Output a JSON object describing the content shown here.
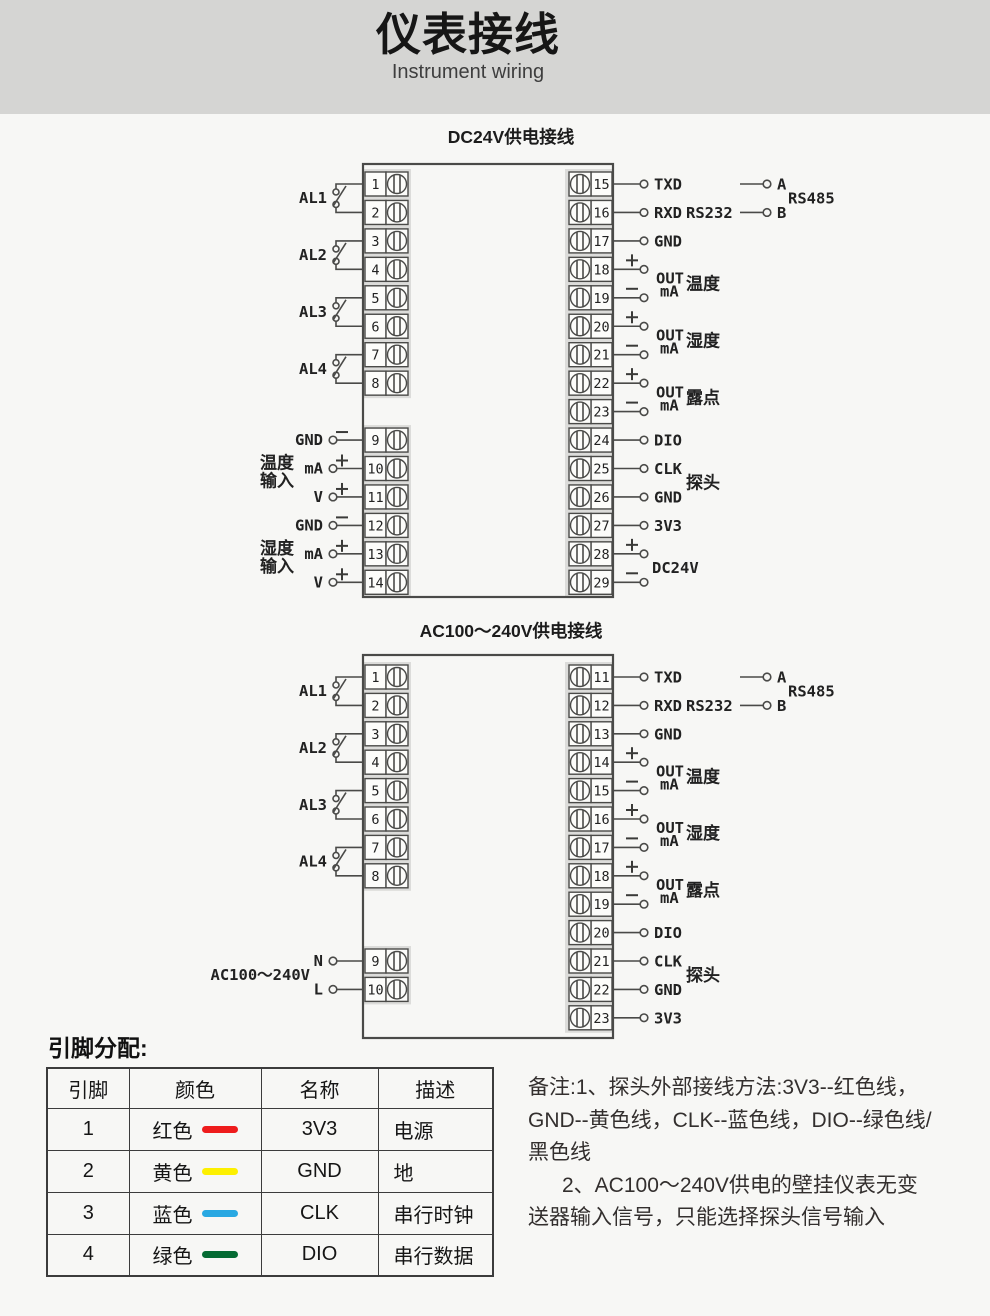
{
  "header": {
    "title": "仪表接线",
    "subtitle": "Instrument wiring"
  },
  "colors": {
    "header_bg": "#d5d5d3",
    "page_bg": "#f7f7f5",
    "line": "#4a4a48"
  },
  "diagrams": [
    {
      "name": "dc24v-wiring-diagram",
      "title": "DC24V供电接线",
      "layout": {
        "rect": {
          "x": 363,
          "y": 164,
          "w": 250,
          "h": 433
        },
        "row_start": 172,
        "row_pitch": 28.45,
        "cell_h": 24,
        "title_y": 143
      },
      "left_terminals": [
        {
          "n": "1",
          "row": 0
        },
        {
          "n": "2",
          "row": 1
        },
        {
          "n": "3",
          "row": 2
        },
        {
          "n": "4",
          "row": 3
        },
        {
          "n": "5",
          "row": 4
        },
        {
          "n": "6",
          "row": 5
        },
        {
          "n": "7",
          "row": 6
        },
        {
          "n": "8",
          "row": 7
        },
        {
          "n": "9",
          "row": 9
        },
        {
          "n": "10",
          "row": 10
        },
        {
          "n": "11",
          "row": 11
        },
        {
          "n": "12",
          "row": 12
        },
        {
          "n": "13",
          "row": 13
        },
        {
          "n": "14",
          "row": 14
        }
      ],
      "right_terminals": [
        {
          "n": "15",
          "row": 0
        },
        {
          "n": "16",
          "row": 1
        },
        {
          "n": "17",
          "row": 2
        },
        {
          "n": "18",
          "row": 3
        },
        {
          "n": "19",
          "row": 4
        },
        {
          "n": "20",
          "row": 5
        },
        {
          "n": "21",
          "row": 6
        },
        {
          "n": "22",
          "row": 7
        },
        {
          "n": "23",
          "row": 8
        },
        {
          "n": "24",
          "row": 9
        },
        {
          "n": "25",
          "row": 10
        },
        {
          "n": "26",
          "row": 11
        },
        {
          "n": "27",
          "row": 12
        },
        {
          "n": "28",
          "row": 13
        },
        {
          "n": "29",
          "row": 14
        }
      ],
      "alarms": [
        {
          "label": "AL1",
          "rows": [
            0,
            1
          ]
        },
        {
          "label": "AL2",
          "rows": [
            2,
            3
          ]
        },
        {
          "label": "AL3",
          "rows": [
            4,
            5
          ]
        },
        {
          "label": "AL4",
          "rows": [
            6,
            7
          ]
        }
      ],
      "inputs": [
        {
          "label_lines": [
            "温度",
            "输入"
          ],
          "pins": [
            {
              "row": 9,
              "name": "GND",
              "sign": "-"
            },
            {
              "row": 10,
              "name": "mA",
              "sign": "+"
            },
            {
              "row": 11,
              "name": "V",
              "sign": "+"
            }
          ]
        },
        {
          "label_lines": [
            "湿度",
            "输入"
          ],
          "pins": [
            {
              "row": 12,
              "name": "GND",
              "sign": "-"
            },
            {
              "row": 13,
              "name": "mA",
              "sign": "+"
            },
            {
              "row": 14,
              "name": "V",
              "sign": "+"
            }
          ]
        }
      ],
      "right_signals": [
        {
          "row": 0,
          "name": "TXD"
        },
        {
          "row": 1,
          "name": "RXD"
        },
        {
          "row": 2,
          "name": "GND"
        },
        {
          "row": 9,
          "name": "DIO"
        },
        {
          "row": 10,
          "name": "CLK"
        },
        {
          "row": 11,
          "name": "GND"
        },
        {
          "row": 12,
          "name": "3V3"
        }
      ],
      "out_pairs": [
        {
          "rows": [
            3,
            4
          ],
          "line1": "OUT",
          "line2": "mA",
          "cn": "温度"
        },
        {
          "rows": [
            5,
            6
          ],
          "line1": "OUT",
          "line2": "mA",
          "cn": "湿度"
        },
        {
          "rows": [
            7,
            8
          ],
          "line1": "OUT",
          "line2": "mA",
          "cn": "露点"
        }
      ],
      "rs232": {
        "label": "RS232",
        "row": 1
      },
      "rs485": {
        "label": "RS485",
        "a": "A",
        "b": "B",
        "rows": [
          0,
          1
        ]
      },
      "probe": {
        "label": "探头",
        "rows": [
          10,
          11
        ]
      },
      "power": {
        "label": "DC24V",
        "rows": [
          13,
          14
        ],
        "signs": [
          "+",
          "-"
        ]
      }
    },
    {
      "name": "ac100-240v-wiring-diagram",
      "title": "AC100～240V供电接线",
      "layout": {
        "rect": {
          "x": 363,
          "y": 655,
          "w": 250,
          "h": 383
        },
        "row_start": 665,
        "row_pitch": 28.4,
        "cell_h": 24,
        "title_y": 637
      },
      "left_terminals": [
        {
          "n": "1",
          "row": 0
        },
        {
          "n": "2",
          "row": 1
        },
        {
          "n": "3",
          "row": 2
        },
        {
          "n": "4",
          "row": 3
        },
        {
          "n": "5",
          "row": 4
        },
        {
          "n": "6",
          "row": 5
        },
        {
          "n": "7",
          "row": 6
        },
        {
          "n": "8",
          "row": 7
        },
        {
          "n": "9",
          "row": 10
        },
        {
          "n": "10",
          "row": 11
        }
      ],
      "right_terminals": [
        {
          "n": "11",
          "row": 0
        },
        {
          "n": "12",
          "row": 1
        },
        {
          "n": "13",
          "row": 2
        },
        {
          "n": "14",
          "row": 3
        },
        {
          "n": "15",
          "row": 4
        },
        {
          "n": "16",
          "row": 5
        },
        {
          "n": "17",
          "row": 6
        },
        {
          "n": "18",
          "row": 7
        },
        {
          "n": "19",
          "row": 8
        },
        {
          "n": "20",
          "row": 9
        },
        {
          "n": "21",
          "row": 10
        },
        {
          "n": "22",
          "row": 11
        },
        {
          "n": "23",
          "row": 12
        }
      ],
      "alarms": [
        {
          "label": "AL1",
          "rows": [
            0,
            1
          ]
        },
        {
          "label": "AL2",
          "rows": [
            2,
            3
          ]
        },
        {
          "label": "AL3",
          "rows": [
            4,
            5
          ]
        },
        {
          "label": "AL4",
          "rows": [
            6,
            7
          ]
        }
      ],
      "inputs": [],
      "ac_power": {
        "label": "AC100～240V",
        "pins": [
          {
            "row": 10,
            "name": "N"
          },
          {
            "row": 11,
            "name": "L"
          }
        ]
      },
      "right_signals": [
        {
          "row": 0,
          "name": "TXD"
        },
        {
          "row": 1,
          "name": "RXD"
        },
        {
          "row": 2,
          "name": "GND"
        },
        {
          "row": 9,
          "name": "DIO"
        },
        {
          "row": 10,
          "name": "CLK"
        },
        {
          "row": 11,
          "name": "GND"
        },
        {
          "row": 12,
          "name": "3V3"
        }
      ],
      "out_pairs": [
        {
          "rows": [
            3,
            4
          ],
          "line1": "OUT",
          "line2": "mA",
          "cn": "温度"
        },
        {
          "rows": [
            5,
            6
          ],
          "line1": "OUT",
          "line2": "mA",
          "cn": "湿度"
        },
        {
          "rows": [
            7,
            8
          ],
          "line1": "OUT",
          "line2": "mA",
          "cn": "露点"
        }
      ],
      "rs232": {
        "label": "RS232",
        "row": 1
      },
      "rs485": {
        "label": "RS485",
        "a": "A",
        "b": "B",
        "rows": [
          0,
          1
        ]
      },
      "probe": {
        "label": "探头",
        "rows": [
          10,
          11
        ]
      }
    }
  ],
  "pin_section": {
    "heading": "引脚分配:",
    "table": {
      "headers": [
        "引脚",
        "颜色",
        "名称",
        "描述"
      ],
      "rows": [
        {
          "pin": "1",
          "color_name": "红色",
          "color_hex": "#ee1c1c",
          "name": "3V3",
          "desc": "电源"
        },
        {
          "pin": "2",
          "color_name": "黄色",
          "color_hex": "#fdf000",
          "name": "GND",
          "desc": "地"
        },
        {
          "pin": "3",
          "color_name": "蓝色",
          "color_hex": "#29a8e2",
          "name": "CLK",
          "desc": "串行时钟"
        },
        {
          "pin": "4",
          "color_name": "绿色",
          "color_hex": "#046a32",
          "name": "DIO",
          "desc": "串行数据"
        }
      ]
    },
    "notes": {
      "lines": [
        "备注:1、探头外部接线方法:3V3--红色线，",
        "GND--黄色线，CLK--蓝色线，DIO--绿色线/",
        "黑色线",
        "2、AC100～240V供电的壁挂仪表无变",
        "送器输入信号，只能选择探头信号输入"
      ]
    }
  }
}
